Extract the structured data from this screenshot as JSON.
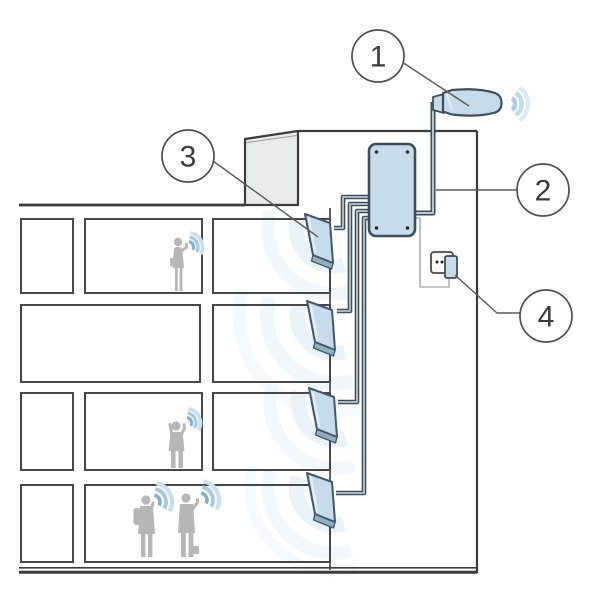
{
  "diagram": {
    "type": "technical-illustration",
    "subject": "in-building cellular signal repeater system",
    "callouts": [
      {
        "label": "1",
        "component": "outdoor-donor-antenna"
      },
      {
        "label": "2",
        "component": "coaxial-cable-to-amplifier"
      },
      {
        "label": "3",
        "component": "indoor-panel-antenna"
      },
      {
        "label": "4",
        "component": "power-outlet-plug"
      }
    ],
    "counts": {
      "indoor_antennas": 4,
      "floors": 4,
      "people": 4
    },
    "colors": {
      "device_fill": "#c6dcea",
      "device_stroke": "#44586a",
      "cable_outline": "#3d4e5a",
      "cable_core": "#b6c5cf",
      "structure_line": "#3b3b3b",
      "roof_block_fill": "#e9eaea",
      "people": "#b6b6b6",
      "wave_strong": "#7fb0d4",
      "wave_faint": "#e2edf5",
      "power_cord": "#b3b3b3"
    }
  }
}
